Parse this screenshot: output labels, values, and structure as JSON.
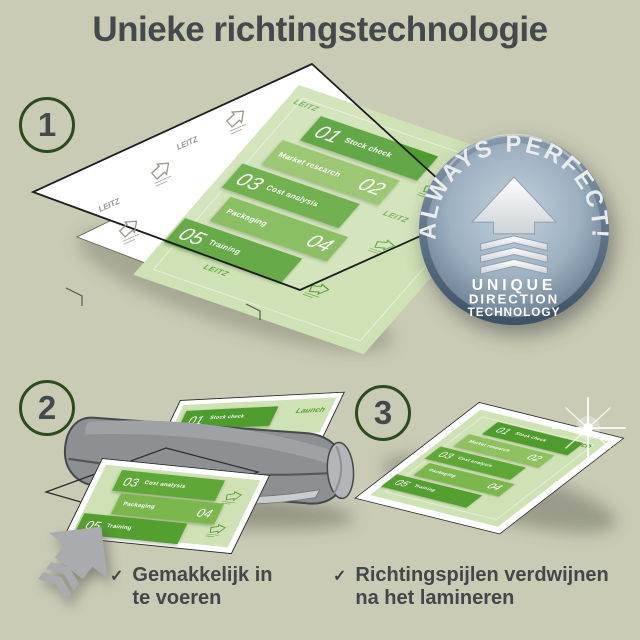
{
  "title": "Unieke richtingstechnologie",
  "steps": [
    {
      "number": "1"
    },
    {
      "number": "2"
    },
    {
      "number": "3"
    }
  ],
  "badge": {
    "arc_text": "ALWAYS PERFECT!",
    "lines": [
      "UNIQUE",
      "DIRECTION",
      "TECHNOLOGY"
    ],
    "face_color": "#9db1c1",
    "rim_color": "#4c617a",
    "arrow_color": "#f2f5f7"
  },
  "infographic": {
    "launch_label": "Launch",
    "watermark_brand": "LEITZ",
    "sheet_color": "#cfe2b5",
    "bands": [
      {
        "num": "01",
        "label": "Stock check",
        "color": "#4e9c2e"
      },
      {
        "num": "02",
        "label": "Market research",
        "color": "#8fc161"
      },
      {
        "num": "03",
        "label": "Cost analysis",
        "color": "#5fa737"
      },
      {
        "num": "04",
        "label": "Packaging",
        "color": "#7cb74e"
      },
      {
        "num": "05",
        "label": "Training",
        "color": "#539f2f"
      }
    ]
  },
  "checklist": [
    {
      "mark": "✓",
      "line1": "Gemakkelijk in",
      "line2": "te voeren"
    },
    {
      "mark": "✓",
      "line1": "Richtingspijlen verdwijnen",
      "line2": "na het lamineren"
    }
  ],
  "palette": {
    "background": "#cacbb4",
    "heading_text": "#45494c",
    "step_circle_border": "#2d4a1e",
    "laminator_gray": "#8d9093",
    "direction_arrow_gray": "#a9abae",
    "pouch_outline": "#1c1e1f"
  }
}
